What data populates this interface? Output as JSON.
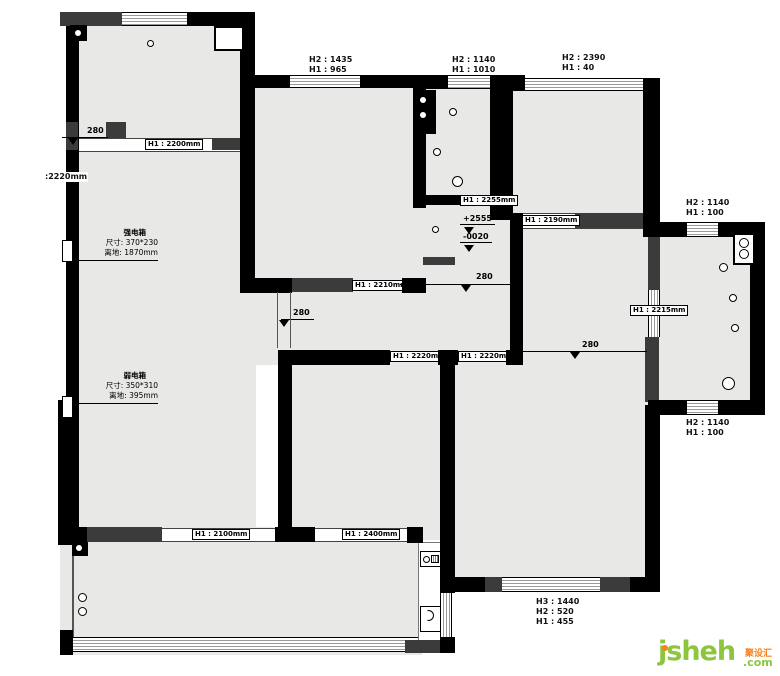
{
  "colors": {
    "wall": "#000000",
    "beam": "#3b3b3b",
    "room_fill": "#e8e8e6",
    "logo_green": "#8cc63e",
    "logo_orange": "#f58220"
  },
  "window_dims": {
    "top_mid": [
      "H2 : 1435",
      "H1 : 965"
    ],
    "top_bath": [
      "H2 : 1140",
      "H1 : 1010"
    ],
    "top_right": [
      "H2 : 2390",
      "H1 : 40"
    ],
    "balcony_top": [
      "H2 : 1140",
      "H1 : 100"
    ],
    "balcony_bottom": [
      "H2 : 1140",
      "H1 : 100"
    ],
    "bottom": [
      "H3 : 1440",
      "H2 : 520",
      "H1 : 455"
    ]
  },
  "lintels": {
    "tl": "H1 : 2200mm",
    "left": ":2220mm",
    "mid": "H1 : 2210mm",
    "bath": "H1 : 2255mm",
    "tr": "H1 : 2190mm",
    "right": "H1 : 2215mm",
    "bed_a": "H1 : 2220mm",
    "bed_b": "H1 : 2220mm",
    "bottom_a": "H1 : 2100mm",
    "bottom_b": "H1 : 2400mm"
  },
  "levels": {
    "tl": "280",
    "mid_left": "280",
    "hall": "280",
    "right": "280",
    "elev_up": "+2555",
    "elev_down": "-0020"
  },
  "electrical": {
    "strong": {
      "title": "强电箱",
      "size": "尺寸: 370*230",
      "height": "离地: 1870mm"
    },
    "weak": {
      "title": "弱电箱",
      "size": "尺寸: 350*310",
      "height": "离地: 395mm"
    }
  },
  "logo": {
    "brand": "jsheh",
    "tld": ".com",
    "cn": "聚设汇"
  }
}
